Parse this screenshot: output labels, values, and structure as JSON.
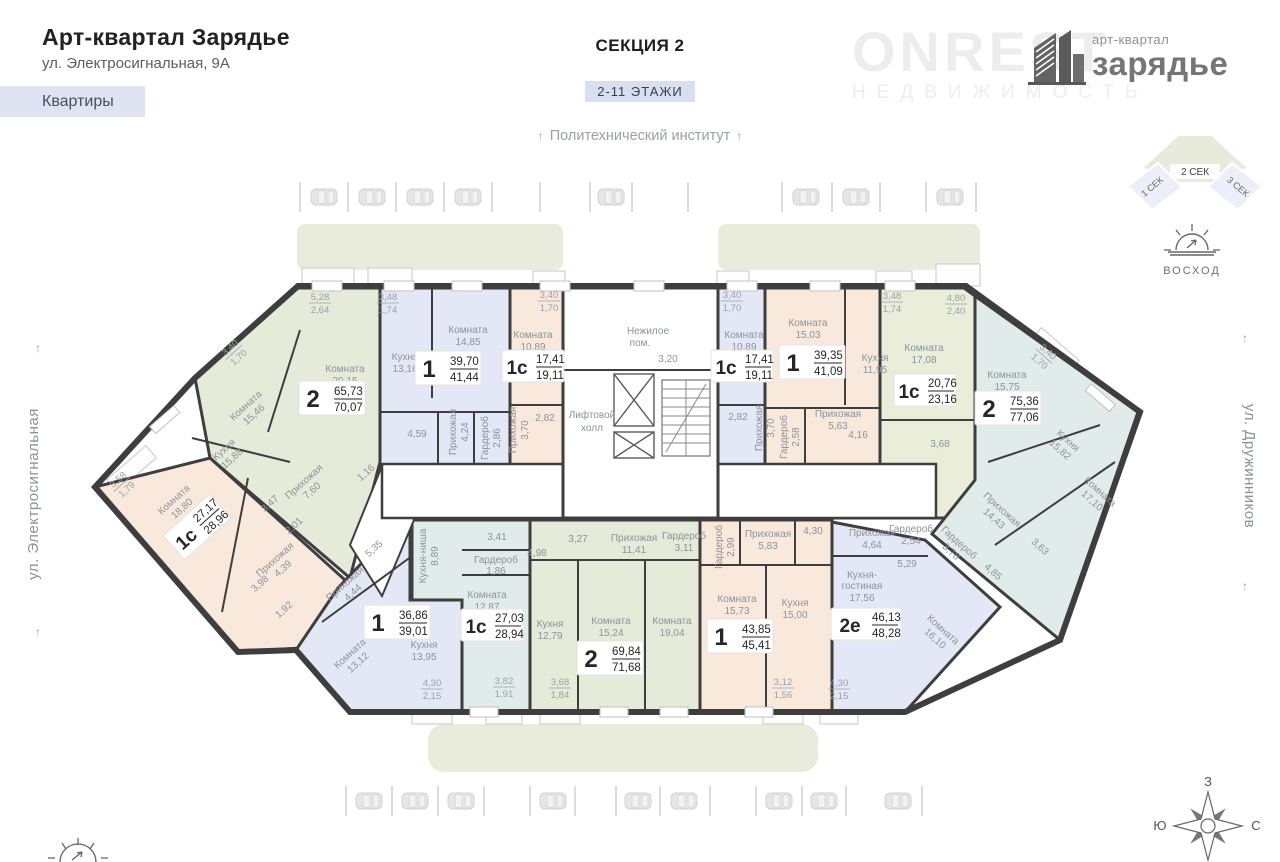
{
  "header": {
    "title": "Арт-квартал Зарядье",
    "address": "ул. Электросигнальная, 9А",
    "apartments_tab": "Квартиры"
  },
  "section": {
    "name": "СЕКЦИЯ 2",
    "floors": "2-11 ЭТАЖИ"
  },
  "landmarks": {
    "top": "Политехнический институт",
    "street_left": "ул. Электросигнальная",
    "street_right": "ул. Дружинников",
    "arrow": "↑"
  },
  "legend": {
    "sunrise": "ВОСХОД"
  },
  "brand": {
    "tagline": "арт-квартал",
    "name": "зарядье",
    "watermark_top": "ONREST",
    "watermark_bottom": "НЕДВИЖИМОСТЬ"
  },
  "minimap": {
    "sec1": "1 СЕК",
    "sec2": "2 СЕК",
    "sec3": "3 СЕК"
  },
  "compass": {
    "top": "З",
    "left": "Ю",
    "right": "С"
  },
  "plan": {
    "core": {
      "title1": "Нежилое",
      "title2": "пом.",
      "area": "3,20",
      "hall1": "Лифтовой",
      "hall2": "холл"
    },
    "apartments": [
      {
        "type": "2",
        "living": "65,73",
        "total": "70,07",
        "color": "#e6ead8",
        "rooms": [
          {
            "name": "Комната",
            "area": "20,15"
          },
          {
            "name": "Комната",
            "area": "15,46"
          },
          {
            "name": "Кухня",
            "area": "15,88"
          },
          {
            "name": "Прихожая",
            "area": "7,60"
          },
          {
            "name": "",
            "area": "3,47"
          },
          {
            "name": "",
            "area": "2,01"
          },
          {
            "name": "",
            "area": "1,16"
          }
        ],
        "balconies": [
          {
            "a": "5,28",
            "b": "2,64"
          },
          {
            "a": "3,40",
            "b": "1,70"
          }
        ]
      },
      {
        "type": "1",
        "living": "39,70",
        "total": "41,44",
        "color": "#e4e8f6",
        "rooms": [
          {
            "name": "Комната",
            "area": "14,85"
          },
          {
            "name": "Кухня",
            "area": "13,16"
          },
          {
            "name": "Прихожая",
            "area": "4,24"
          },
          {
            "name": "Гардероб",
            "area": "2,86"
          },
          {
            "name": "",
            "area": "4,59"
          }
        ],
        "balconies": [
          {
            "a": "3,48",
            "b": "1,74"
          }
        ]
      },
      {
        "type": "1с",
        "living": "17,41",
        "total": "19,11",
        "color": "#f9e9dc",
        "rooms": [
          {
            "name": "Комната",
            "area": "10,89"
          },
          {
            "name": "Прихожая",
            "area": "3,70"
          },
          {
            "name": "",
            "area": "2,82"
          }
        ],
        "balconies": [
          {
            "a": "3,40",
            "b": "1,70"
          }
        ]
      },
      {
        "type": "1с",
        "living": "17,41",
        "total": "19,11",
        "color": "#e4e8f6",
        "rooms": [
          {
            "name": "Комната",
            "area": "10,89"
          },
          {
            "name": "Прихожая",
            "area": "3,70"
          },
          {
            "name": "",
            "area": "2,82"
          }
        ],
        "balconies": [
          {
            "a": "3,40",
            "b": "1,70"
          }
        ]
      },
      {
        "type": "1",
        "living": "39,35",
        "total": "41,09",
        "color": "#f9e9dc",
        "rooms": [
          {
            "name": "Комната",
            "area": "15,03"
          },
          {
            "name": "Кухня",
            "area": "11,95"
          },
          {
            "name": "Прихожая",
            "area": "5,63"
          },
          {
            "name": "Гардероб",
            "area": "2,58"
          },
          {
            "name": "",
            "area": "4,16"
          }
        ],
        "balconies": [
          {
            "a": "3,48",
            "b": "1,74"
          }
        ]
      },
      {
        "type": "1с",
        "living": "20,76",
        "total": "23,16",
        "color": "#e9edda",
        "rooms": [
          {
            "name": "Комната",
            "area": "17,08"
          },
          {
            "name": "",
            "area": "3,68"
          }
        ],
        "balconies": [
          {
            "a": "4,80",
            "b": "2,40"
          }
        ]
      },
      {
        "type": "2",
        "living": "75,36",
        "total": "77,06",
        "color": "#e1ecea",
        "rooms": [
          {
            "name": "Комната",
            "area": "15,75"
          },
          {
            "name": "Кухня",
            "area": "15,82"
          },
          {
            "name": "Комната",
            "area": "17,10"
          },
          {
            "name": "Прихожая",
            "area": "14,43"
          },
          {
            "name": "Гардероб",
            "area": "3,78"
          },
          {
            "name": "",
            "area": "4,85"
          },
          {
            "name": "",
            "area": "3,63"
          }
        ],
        "balconies": [
          {
            "a": "3,40",
            "b": "1,70"
          }
        ]
      },
      {
        "type": "1с",
        "living": "27,17",
        "total": "28,96",
        "color": "#f9e9dc",
        "rooms": [
          {
            "name": "Комната",
            "area": "18,80"
          },
          {
            "name": "Прихожая",
            "area": "4,39"
          },
          {
            "name": "",
            "area": "3,98"
          },
          {
            "name": "",
            "area": "1,92"
          }
        ],
        "balconies": [
          {
            "a": "3,58",
            "b": "1,79"
          }
        ]
      },
      {
        "type": "1",
        "living": "36,86",
        "total": "39,01",
        "color": "#e4e8f6",
        "rooms": [
          {
            "name": "Прихожая",
            "area": "4,44"
          },
          {
            "name": "",
            "area": "5,35"
          },
          {
            "name": "Комната",
            "area": "13,12"
          },
          {
            "name": "Кухня",
            "area": "13,95"
          }
        ],
        "balconies": [
          {
            "a": "4,30",
            "b": "2,15"
          }
        ]
      },
      {
        "type": "1с",
        "living": "27,03",
        "total": "28,94",
        "color": "#e1ecea",
        "rooms": [
          {
            "name": "Кухня-ниша",
            "area": "8,89"
          },
          {
            "name": "Гардероб",
            "area": "1,86"
          },
          {
            "name": "Комната",
            "area": "12,87"
          },
          {
            "name": "",
            "area": "3,41"
          }
        ],
        "balconies": [
          {
            "a": "3,82",
            "b": "1,91"
          }
        ]
      },
      {
        "type": "2",
        "living": "69,84",
        "total": "71,68",
        "color": "#e6ead8",
        "rooms": [
          {
            "name": "Прихожая",
            "area": "11,41"
          },
          {
            "name": "Гардероб",
            "area": "3,11"
          },
          {
            "name": "",
            "area": "3,27"
          },
          {
            "name": "",
            "area": "4,98"
          },
          {
            "name": "Кухня",
            "area": "12,79"
          },
          {
            "name": "Комната",
            "area": "15,24"
          },
          {
            "name": "Комната",
            "area": "19,04"
          }
        ],
        "balconies": [
          {
            "a": "3,68",
            "b": "1,84"
          }
        ]
      },
      {
        "type": "1",
        "living": "43,85",
        "total": "45,41",
        "color": "#f9e9dc",
        "rooms": [
          {
            "name": "Гардероб",
            "area": "2,99"
          },
          {
            "name": "Прихожая",
            "area": "5,83"
          },
          {
            "name": "Комната",
            "area": "15,73"
          },
          {
            "name": "Кухня",
            "area": "15,00"
          },
          {
            "name": "",
            "area": "4,30"
          }
        ],
        "balconies": [
          {
            "a": "3,12",
            "b": "1,56"
          }
        ]
      },
      {
        "type": "2е",
        "living": "46,13",
        "total": "48,28",
        "color": "#e4e8f6",
        "rooms": [
          {
            "name": "Прихожая",
            "area": "4,64"
          },
          {
            "name": "Гардероб",
            "area": "2,54"
          },
          {
            "name": "",
            "area": "5,29"
          },
          {
            "name1": "Кухня-",
            "name2": "гостиная",
            "area": "17,56"
          },
          {
            "name": "Комната",
            "area": "16,10"
          }
        ],
        "balconies": [
          {
            "a": "4,30",
            "b": "2,15"
          }
        ]
      }
    ]
  }
}
